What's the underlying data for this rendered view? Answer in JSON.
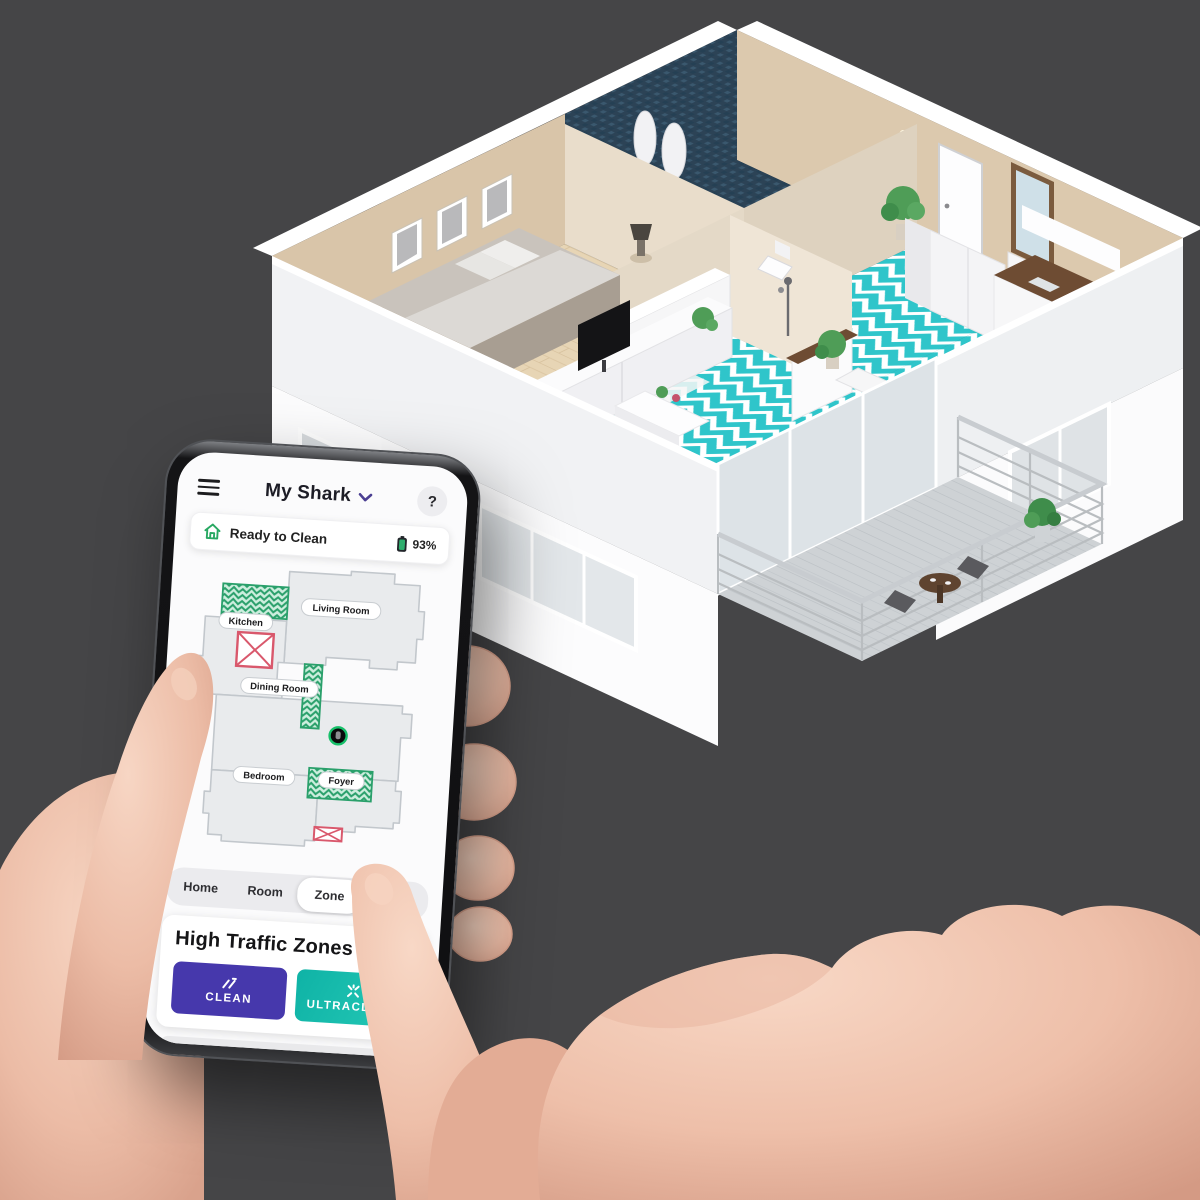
{
  "scene": {
    "background_color": "#454547",
    "floorplan_floor_teal": "#2fc5ca",
    "description_house": "isometric-3d-apartment-render",
    "description_hands": "hands-holding-phone"
  },
  "app": {
    "title": "My Shark",
    "help_label": "?",
    "status": {
      "text": "Ready to Clean",
      "battery_percent": "93%"
    },
    "map": {
      "room_labels": {
        "living": "Living Room",
        "kitchen": "Kitchen",
        "dining": "Dining Room",
        "bedroom": "Bedroom",
        "foyer": "Foyer"
      }
    },
    "tabs": [
      {
        "label": "Home",
        "active": false
      },
      {
        "label": "Room",
        "active": false
      },
      {
        "label": "Zone",
        "active": true
      },
      {
        "label": "Spot",
        "active": false
      }
    ],
    "panel": {
      "heading": "High Traffic Zones",
      "clean_label": "CLEAN",
      "ultraclean_label": "ULTRACLEAN"
    }
  },
  "colors": {
    "accent_green": "#28a862",
    "zone_green_fill": "#cdeede",
    "zone_green_stroke": "#2aa06b",
    "no_go_red": "#d9586c",
    "clean_button": "#4638ac",
    "ultraclean_button": "#14b8ab",
    "title_chevron_purple": "#4b3f92",
    "map_floor_gray": "#e9ebed",
    "map_wall_gray": "#c2c7cc"
  }
}
